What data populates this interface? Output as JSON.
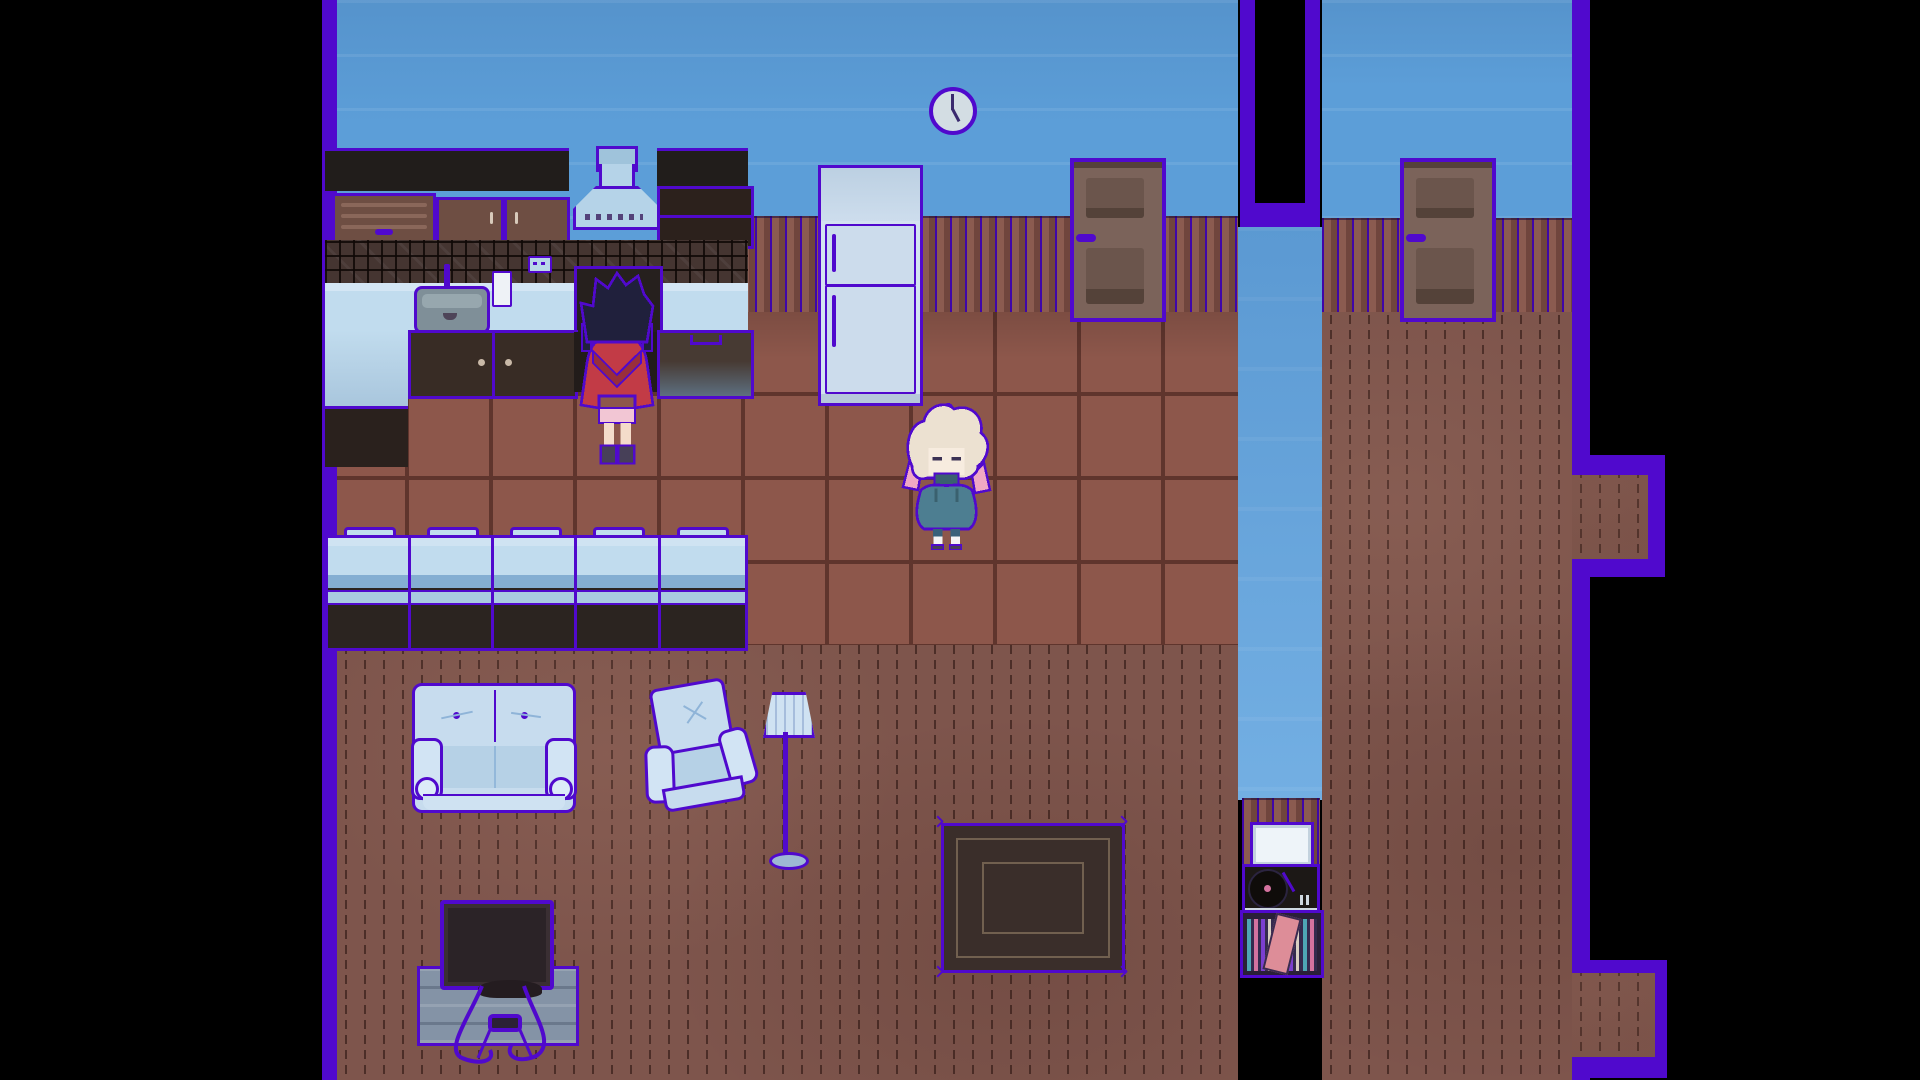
{
  "meta": {
    "type": "game-screenshot",
    "style": "top-down pixel-art RPG house interior",
    "visible_text": "none"
  },
  "scene": {
    "rooms": [
      "kitchen-living-room",
      "hallway",
      "side-room"
    ],
    "objects": [
      "wall-clock",
      "refrigerator",
      "range-hood",
      "kitchen-sink",
      "faucet",
      "paper-cup",
      "wall-outlet",
      "stove",
      "upper-cabinets",
      "drawer-unit",
      "lower-cabinets",
      "bar-counter",
      "interior-door-left",
      "interior-door-right",
      "dark-doorway",
      "loveseat-couch",
      "armchair",
      "floor-lamp",
      "area-rug",
      "television",
      "tv-stand",
      "game-console",
      "picture-frame",
      "turntable",
      "record-crate"
    ],
    "characters": [
      {
        "id": "red-hooded-kid",
        "pose": "facing-up-at-stove",
        "hair": "dark-navy",
        "outfit": "red-hooded-poncho"
      },
      {
        "id": "blonde-kid",
        "pose": "facing-down",
        "hair": "cream-with-pink-tips",
        "outfit": "teal-sweater-dress"
      }
    ],
    "clock_time_approx": "6:00"
  },
  "colors": {
    "purple": "#5009cd",
    "purple-deep": "#3f06a8",
    "wall-blue": "#5c9ed8",
    "hall-blue": "#63a6e0",
    "carpet": "#7e554c",
    "carpet-stroke": "#4c2e28",
    "tile": "#8d574b",
    "grout": "#5f352d",
    "panel-light": "#8b5b50",
    "panel-dark": "#70453d",
    "door-face": "#7b635a",
    "door-panel": "#6b554c",
    "door-band": "#544239",
    "black-band": "#211d1b",
    "cab-brown": "#6e4e43",
    "cab-dark": "#382c25",
    "counter-blue": "#c1dcee",
    "counter-mid": "#84aed2",
    "counter-strip": "#a9cbe0",
    "counter-base": "#2b2420",
    "sofa": "#c7dcee",
    "fridge": "#d3e2f0",
    "sink-gray": "#7f8f98",
    "hood-blue": "#b5d3e8",
    "stand-gray": "#8493a6",
    "rug-dark": "#3a2e2a",
    "rug-line": "#71604f",
    "screen-dark": "#2b2327",
    "skin": "#f4dcca",
    "red": "#c23b46",
    "red-dark": "#992e3b",
    "navy": "#20203c",
    "cream": "#ece1d1",
    "pink": "#f0a8c4",
    "teal": "#4d7e91",
    "teal-dark": "#3a616f",
    "record-teal": "#4ea6b5",
    "record-pink": "#d4729f",
    "record-violet": "#7b3fd0",
    "sleeve-pink": "#dd8d98"
  }
}
